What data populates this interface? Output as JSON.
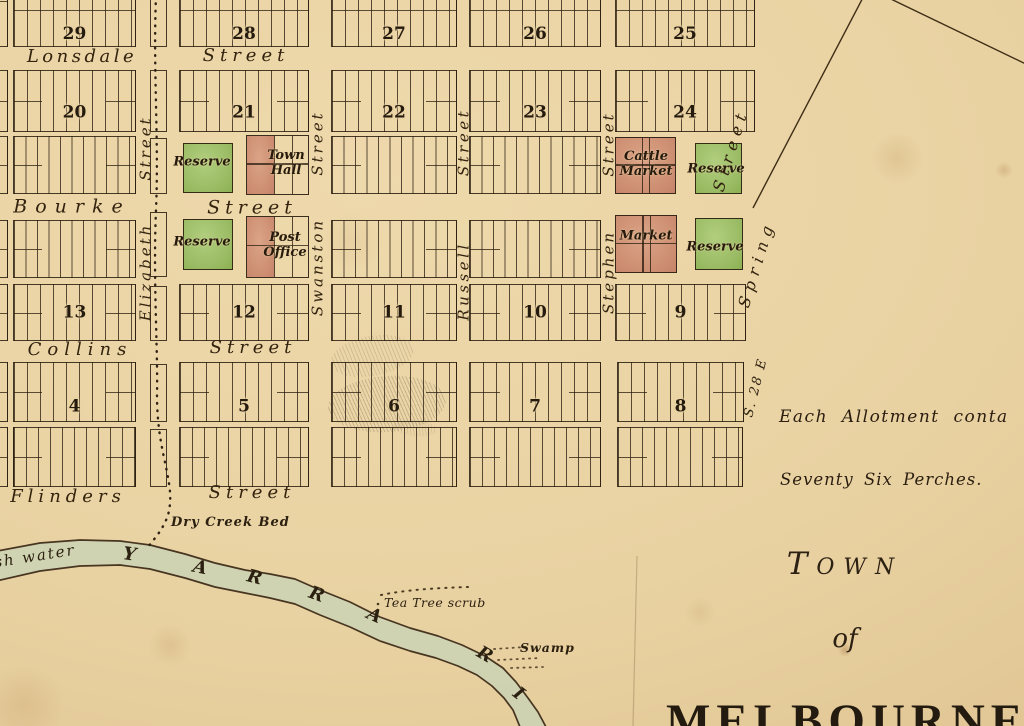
{
  "title": {
    "line1": "Town",
    "line2": "of",
    "line3": "MELBOURNE"
  },
  "notes": {
    "allotment1": "Each Allotment conta",
    "allotment2": "Seventy Six Perches.",
    "bearing": "S. 28 E"
  },
  "colors": {
    "paper": "#e9d2a2",
    "ink": "#2f2215",
    "reserve_green": "#a3c36d",
    "market_red": "#d09478",
    "river": "#ccd3b2"
  },
  "streets": {
    "horizontal": [
      {
        "name": "Lonsdale",
        "suffix": "Street",
        "nx": 82,
        "ny": 57,
        "sx": 246,
        "sy": 56,
        "fs": 18,
        "nls": 3.5,
        "sls": 5
      },
      {
        "name": "Bourke",
        "suffix": "Street",
        "nx": 72,
        "ny": 207,
        "sx": 252,
        "sy": 208,
        "fs": 19,
        "nls": 8,
        "sls": 5
      },
      {
        "name": "Collins",
        "suffix": "Street",
        "nx": 80,
        "ny": 350,
        "sx": 253,
        "sy": 348,
        "fs": 18,
        "nls": 6,
        "sls": 5
      },
      {
        "name": "Flinders",
        "suffix": "Street",
        "nx": 68,
        "ny": 497,
        "sx": 252,
        "sy": 493,
        "fs": 18,
        "nls": 5,
        "sls": 5
      }
    ],
    "vertical": [
      {
        "name": "Elizabeth",
        "suffix": "Street",
        "nx": 146,
        "ny": 272,
        "sx": 146,
        "sy": 148,
        "angle": -90,
        "fs": 15,
        "ls": 3
      },
      {
        "name": "Swanston",
        "suffix": "Street",
        "nx": 318,
        "ny": 267,
        "sx": 318,
        "sy": 143,
        "angle": -90,
        "fs": 15,
        "ls": 3
      },
      {
        "name": "Russell",
        "suffix": "Street",
        "nx": 464,
        "ny": 281,
        "sx": 464,
        "sy": 142,
        "angle": -90,
        "fs": 15,
        "ls": 3.5
      },
      {
        "name": "Stephen",
        "suffix": "Street",
        "nx": 609,
        "ny": 272,
        "sx": 609,
        "sy": 144,
        "angle": -90,
        "fs": 15,
        "ls": 3
      },
      {
        "name": "Spring",
        "suffix": "Street",
        "nx": 757,
        "ny": 264,
        "sx": 731,
        "sy": 150,
        "angle": -73,
        "fs": 16,
        "ls": 6
      }
    ]
  },
  "grid": {
    "block_rows": [
      {
        "y": -45,
        "h": 92,
        "sp": 13,
        "hl": 0.6,
        "nb": true,
        "cells": [
          {
            "n": "29",
            "x": 13,
            "w": 123
          },
          {
            "n": "28",
            "x": 179,
            "w": 130
          },
          {
            "n": "27",
            "x": 331,
            "w": 126
          },
          {
            "n": "26",
            "x": 469,
            "w": 132
          },
          {
            "n": "25",
            "x": 615,
            "w": 140
          }
        ]
      },
      {
        "y": 70,
        "h": 62,
        "sp": 13,
        "ends": true,
        "ndy": 12,
        "cells": [
          {
            "n": "20",
            "x": 13,
            "w": 123
          },
          {
            "n": "21",
            "x": 179,
            "w": 130
          },
          {
            "n": "22",
            "x": 331,
            "w": 126
          },
          {
            "n": "23",
            "x": 469,
            "w": 132
          },
          {
            "n": "24",
            "x": 615,
            "w": 140
          }
        ]
      },
      {
        "y": 136,
        "h": 58,
        "sp": 11.5,
        "ends": true,
        "cells": [
          {
            "x": 13,
            "w": 123
          },
          {
            "x": 331,
            "w": 126
          },
          {
            "x": 469,
            "w": 132
          }
        ]
      },
      {
        "y": 220,
        "h": 58,
        "sp": 11.5,
        "ends": true,
        "cells": [
          {
            "x": 13,
            "w": 123
          },
          {
            "x": 331,
            "w": 126
          },
          {
            "x": 469,
            "w": 132
          }
        ]
      },
      {
        "y": 284,
        "h": 57,
        "sp": 13,
        "ends": true,
        "ndy": 0,
        "cells": [
          {
            "n": "13",
            "x": 13,
            "w": 123
          },
          {
            "n": "12",
            "x": 179,
            "w": 130
          },
          {
            "n": "11",
            "x": 331,
            "w": 126
          },
          {
            "n": "10",
            "x": 469,
            "w": 132
          },
          {
            "n": "9",
            "x": 615,
            "w": 131
          }
        ]
      },
      {
        "y": 362,
        "h": 60,
        "sp": 13,
        "ends": true,
        "ndy": 15,
        "cells": [
          {
            "n": "4",
            "x": 13,
            "w": 123
          },
          {
            "n": "5",
            "x": 179,
            "w": 130
          },
          {
            "n": "6",
            "x": 331,
            "w": 126
          },
          {
            "n": "7",
            "x": 469,
            "w": 132
          },
          {
            "n": "8",
            "x": 617,
            "w": 127
          }
        ]
      },
      {
        "y": 427,
        "h": 60,
        "sp": 12,
        "ends": true,
        "cells": [
          {
            "x": 13,
            "w": 123
          },
          {
            "x": 179,
            "w": 130
          },
          {
            "x": 331,
            "w": 126
          },
          {
            "x": 469,
            "w": 132
          },
          {
            "x": 617,
            "w": 126
          }
        ]
      }
    ],
    "fragments": [
      {
        "x": -26,
        "w": 34,
        "y": -45,
        "h": 92
      },
      {
        "x": -26,
        "w": 34,
        "y": 70,
        "h": 62
      },
      {
        "x": -26,
        "w": 34,
        "y": 136,
        "h": 58
      },
      {
        "x": -26,
        "w": 34,
        "y": 220,
        "h": 58
      },
      {
        "x": -26,
        "w": 34,
        "y": 284,
        "h": 57
      },
      {
        "x": -26,
        "w": 34,
        "y": 362,
        "h": 60
      },
      {
        "x": -26,
        "w": 34,
        "y": 427,
        "h": 60
      }
    ],
    "lanes": [
      {
        "x": 150,
        "w": 17,
        "y": -10,
        "h": 57
      },
      {
        "x": 150,
        "w": 17,
        "y": 70,
        "h": 62
      },
      {
        "x": 150,
        "w": 17,
        "y": 138,
        "h": 56
      },
      {
        "x": 150,
        "w": 17,
        "y": 212,
        "h": 65
      },
      {
        "x": 150,
        "w": 17,
        "y": 286,
        "h": 55
      },
      {
        "x": 150,
        "w": 17,
        "y": 364,
        "h": 58
      },
      {
        "x": 150,
        "w": 17,
        "y": 429,
        "h": 58
      }
    ]
  },
  "sites": [
    {
      "kind": "reserve",
      "lines": [
        "Reserve"
      ],
      "x": 183,
      "y": 143,
      "w": 50,
      "h": 50,
      "lcx": 202,
      "lcy": 162
    },
    {
      "kind": "hall",
      "lines": [
        "Town",
        "Hall"
      ],
      "x": 246,
      "y": 135,
      "w": 63,
      "h": 60,
      "red_w": 27,
      "lcx": 286,
      "lcy": 163
    },
    {
      "kind": "market",
      "lines": [
        "Cattle",
        "Market"
      ],
      "x": 615,
      "y": 137,
      "w": 61,
      "h": 57,
      "lcx": 646,
      "lcy": 164
    },
    {
      "kind": "reserve",
      "lines": [
        "Reserve"
      ],
      "x": 695,
      "y": 143,
      "w": 47,
      "h": 51,
      "lcx": 716,
      "lcy": 169
    },
    {
      "kind": "reserve",
      "lines": [
        "Reserve"
      ],
      "x": 183,
      "y": 219,
      "w": 50,
      "h": 51,
      "lcx": 202,
      "lcy": 242
    },
    {
      "kind": "hall",
      "lines": [
        "Post",
        "Office"
      ],
      "x": 246,
      "y": 216,
      "w": 63,
      "h": 62,
      "red_w": 27,
      "lcx": 285,
      "lcy": 245
    },
    {
      "kind": "market",
      "lines": [
        "Market"
      ],
      "x": 615,
      "y": 215,
      "w": 62,
      "h": 58,
      "lcx": 646,
      "lcy": 236
    },
    {
      "kind": "reserve",
      "lines": [
        "Reserve"
      ],
      "x": 695,
      "y": 218,
      "w": 48,
      "h": 52,
      "lcx": 715,
      "lcy": 247
    }
  ],
  "features": {
    "dry_creek": "Dry Creek Bed",
    "tea_tree": "Tea Tree scrub",
    "swamp": "Swamp",
    "water": "sh water",
    "river_name_letters": [
      {
        "ch": "Y",
        "x": 123,
        "y": 546,
        "r": 8
      },
      {
        "ch": "A",
        "x": 193,
        "y": 559,
        "r": 12
      },
      {
        "ch": "R",
        "x": 247,
        "y": 569,
        "r": 14
      },
      {
        "ch": "R",
        "x": 309,
        "y": 586,
        "r": 20
      },
      {
        "ch": "A",
        "x": 367,
        "y": 607,
        "r": 24
      },
      {
        "ch": "R",
        "x": 477,
        "y": 646,
        "r": 30
      },
      {
        "ch": "I",
        "x": 514,
        "y": 685,
        "r": 38
      }
    ]
  }
}
